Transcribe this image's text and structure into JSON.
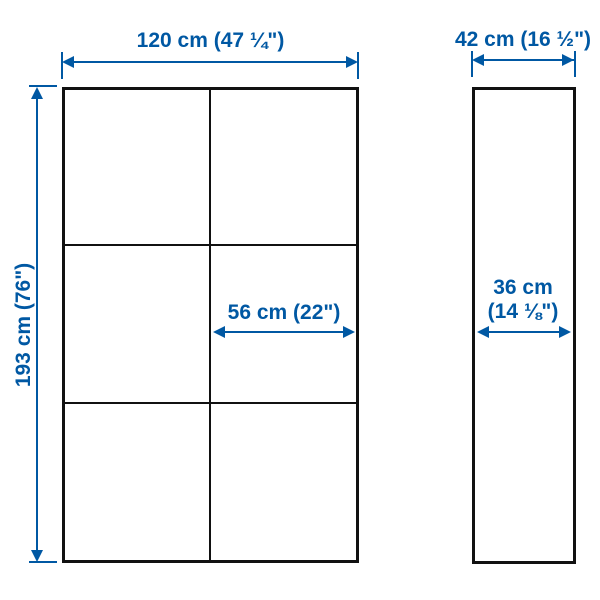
{
  "colors": {
    "accent": "#0058a3",
    "outline": "#111111",
    "background": "#ffffff"
  },
  "diagram": {
    "front_view": {
      "overall_width_label": "120 cm (47 ¼\")",
      "overall_height_label": "193 cm (76\")",
      "section_width_label": "56 cm (22\")",
      "grid_columns": 2,
      "grid_rows": 3
    },
    "side_view": {
      "overall_depth_label": "42 cm (16 ½\")",
      "inner_depth_label_line1": "36 cm",
      "inner_depth_label_line2": "(14 ⅛\")"
    }
  }
}
